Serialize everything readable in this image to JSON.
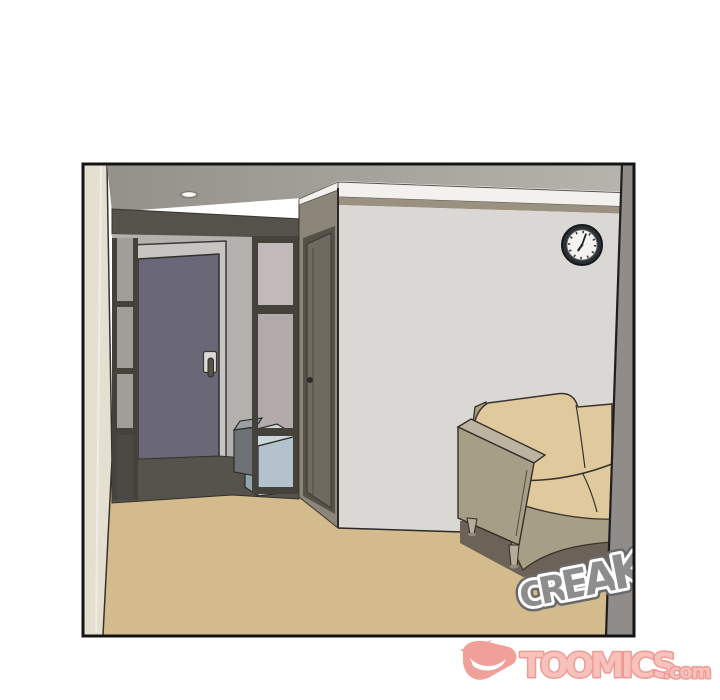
{
  "scene": {
    "description": "Webtoon panel: empty apartment interior seen from a doorway — entrance door, shelf unit with storage boxes, wall clock, beige sofa and a creaking sound effect",
    "objects": [
      "entrance-door",
      "shoe-shelf",
      "storage-box-gray",
      "storage-box-blue",
      "side-door",
      "wall-clock",
      "ceiling-light",
      "sofa"
    ]
  },
  "sfx": {
    "text": "CREAK",
    "letters": [
      "C",
      "R",
      "E",
      "A",
      "K"
    ]
  },
  "watermark": {
    "brand": "TOOMICS",
    "suffix": ".com"
  },
  "colors": {
    "floor": "#d4bb8e",
    "floorEntry": "#56534c",
    "wallLeft": "#e4dfd1",
    "ceilingDark": "#94908a",
    "ceilingLight": "#b7b4ae",
    "soffit": "#55524b",
    "wallEntry": "#b3b1ae",
    "doorFrame": "#c7c5c1",
    "door": "#6a6778",
    "handlePlate": "#dbdad7",
    "handleLever": "#54514b",
    "shelfFrame": "#45423b",
    "shelfBackA": "#a19e99",
    "shelfBackB": "#4b4944",
    "shelfBackC": "#c2b9ba",
    "shelfBackD": "#b3aaab",
    "shelfBackE": "#9e9a97",
    "boxGrayTop": "#9aa1a4",
    "boxGrayFront": "#6e7277",
    "boxBlueTop": "#ccd7db",
    "boxBlueFront": "#b4c3cb",
    "boxBlueSide": "#93a5ae",
    "wallSide": "#8c8678",
    "doorSideFrame": "#54514a",
    "doorSide": "#6f6a5f",
    "molding": "#f2f1ed",
    "bandKhaki": "#9b9181",
    "wallMain": "#dad8d4",
    "clockRim": "#2c3136",
    "clockFace": "#f4f3f0",
    "shadow": "#6c6257",
    "cushion": "#e1c99e",
    "couchFrame": "#a79e88",
    "couchFrameTop": "#bcb4a0",
    "couchLeg": "#b5ac9b",
    "wallRightEdge": "#908c8a",
    "lampGlow": "#f8f7f4",
    "lampRecess": "#8f8c86",
    "sfxFill": "#8d8d8d",
    "sfxRim": "#6a6a6a",
    "sfxOutline": "#ffffff",
    "logoPink": "#ef968f",
    "logoFill": "#f7bcb5",
    "logoStroke": "#ee9089",
    "border": "#141414",
    "outline": "#33302b"
  }
}
